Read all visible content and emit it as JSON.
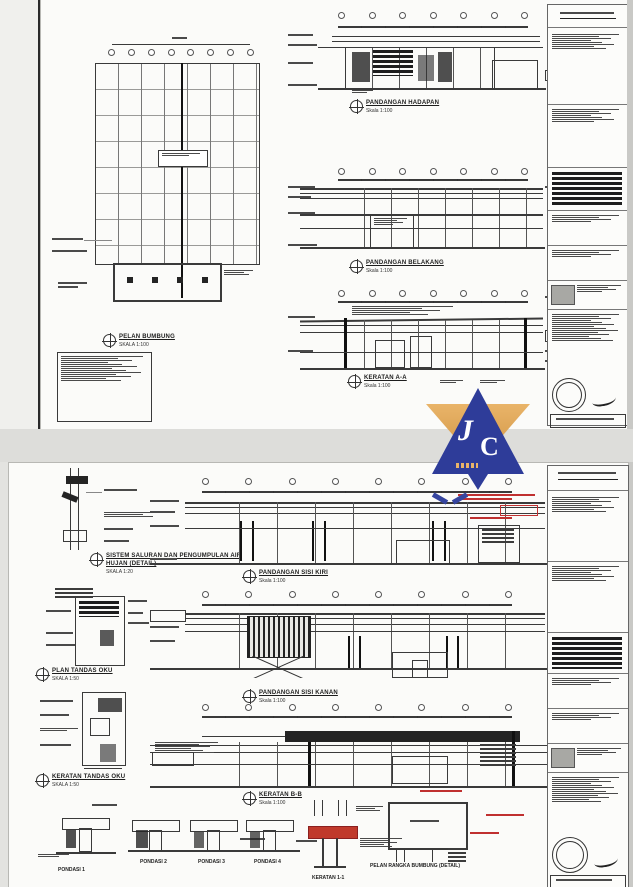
{
  "sheet1": {
    "plan": {
      "title": "PELAN BUMBUNG",
      "scale": "SKALA 1:100"
    },
    "elev_front": {
      "title": "PANDANGAN HADAPAN",
      "scale": "Skala 1:100"
    },
    "elev_rear": {
      "title": "PANDANGAN BELAKANG",
      "scale": "Skala 1:100"
    },
    "section_aa": {
      "title": "KERATAN A-A",
      "scale": "Skala 1:100"
    }
  },
  "sheet2": {
    "gutter_detail": {
      "title_line1": "SISTEM SALURAN DAN PENGUMPULAN AIR",
      "title_line2": "HUJAN (DETAIL)",
      "scale": "SKALA 1:20"
    },
    "plan_tandas": {
      "title": "PLAN TANDAS OKU",
      "scale": "SKALA 1:50"
    },
    "keratan_tandas": {
      "title": "KERATAN TANDAS OKU",
      "scale": "SKALA 1:50"
    },
    "elev_left": {
      "title": "PANDANGAN SISI KIRI",
      "scale": "Skala 1:100"
    },
    "elev_right": {
      "title": "PANDANGAN SISI KANAN",
      "scale": "Skala 1:100"
    },
    "section_bb": {
      "title": "KERATAN B-B",
      "scale": "Skala 1:100"
    },
    "footings": {
      "labels": [
        "PONDASI 1",
        "PONDASI 2",
        "PONDASI 3",
        "PONDASI 4"
      ]
    },
    "beam_detail": {
      "title": "KERATAN 1-1"
    },
    "roof_frame_detail": {
      "title": "PELAN RANGKA BUMBUNG (DETAIL)"
    }
  },
  "logo": {
    "letter_j": "J",
    "letter_c": "C",
    "blue": "#2e3c99",
    "orange": "#dfa453"
  },
  "colors": {
    "line": "#333333",
    "red_markup": "#c03030",
    "sheet": "#fbfbf9",
    "background": "#e3e3e0"
  }
}
